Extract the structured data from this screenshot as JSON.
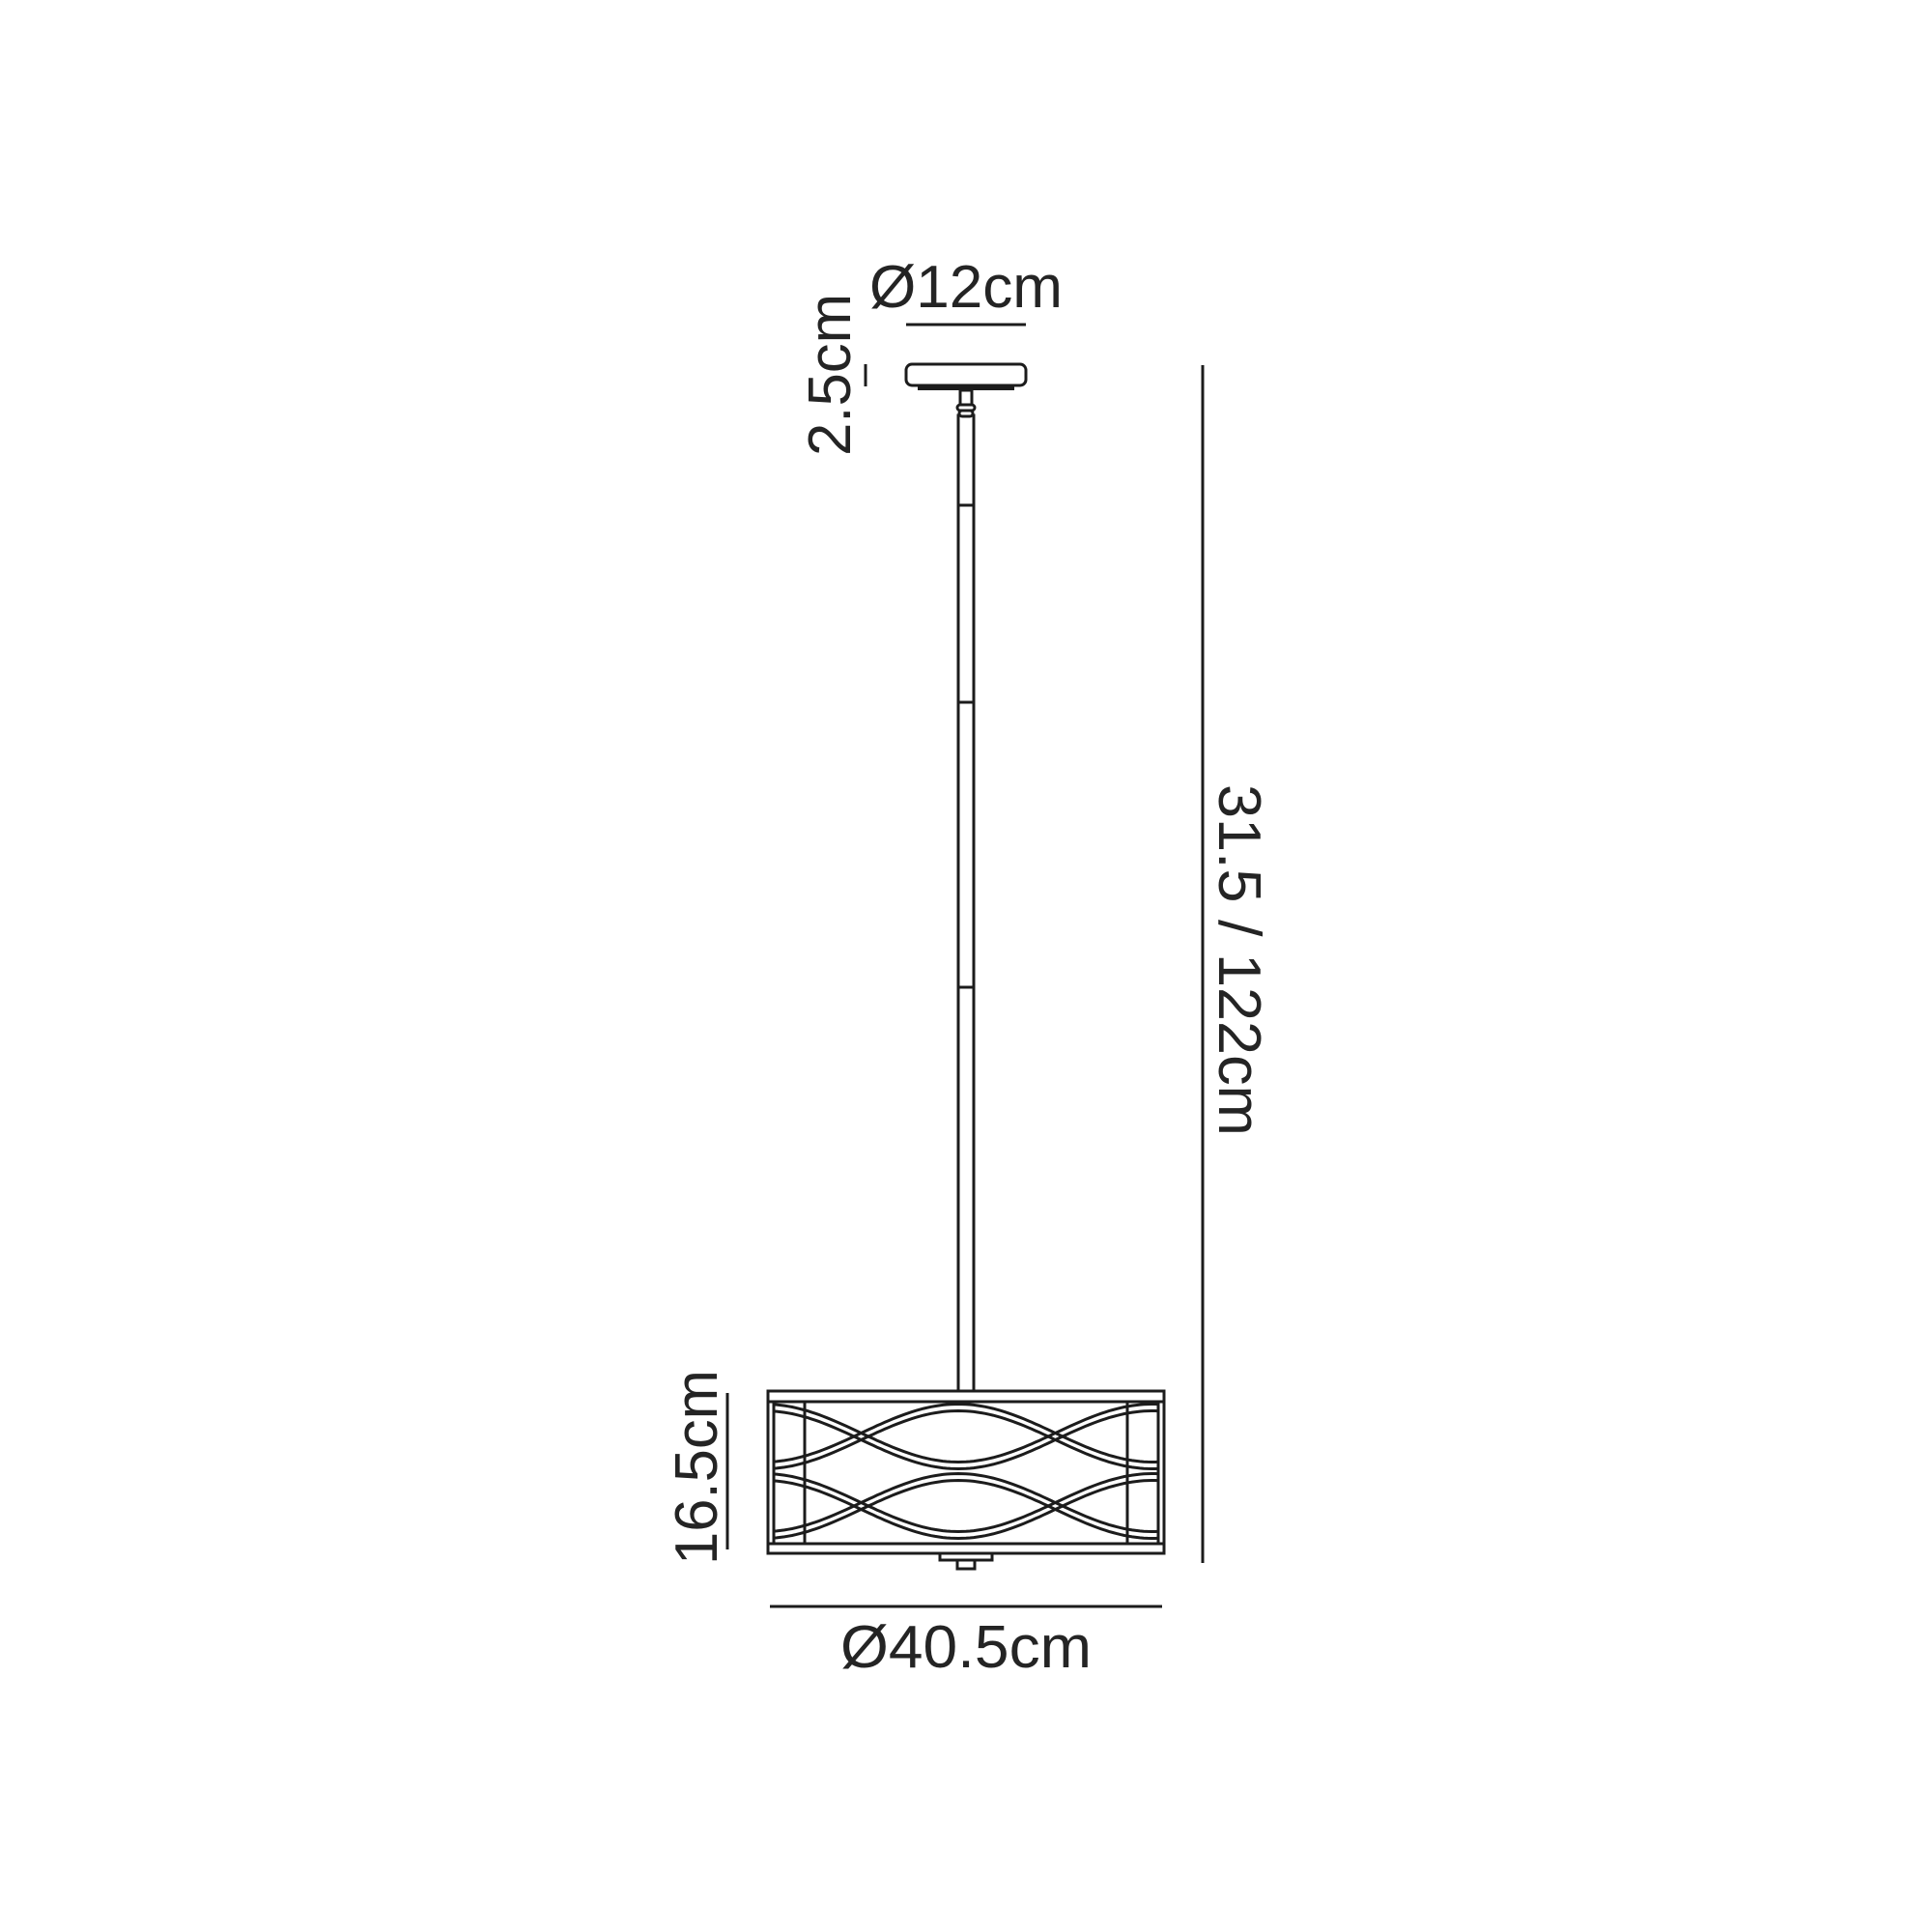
{
  "labels": {
    "canopy_diameter": "Ø12cm",
    "canopy_height": "2.5cm",
    "drop_height": "31.5 / 122cm",
    "shade_height": "16.5cm",
    "shade_diameter": "Ø40.5cm"
  },
  "colors": {
    "line": "#1c1c1c",
    "text": "#242424",
    "background": "#ffffff"
  }
}
